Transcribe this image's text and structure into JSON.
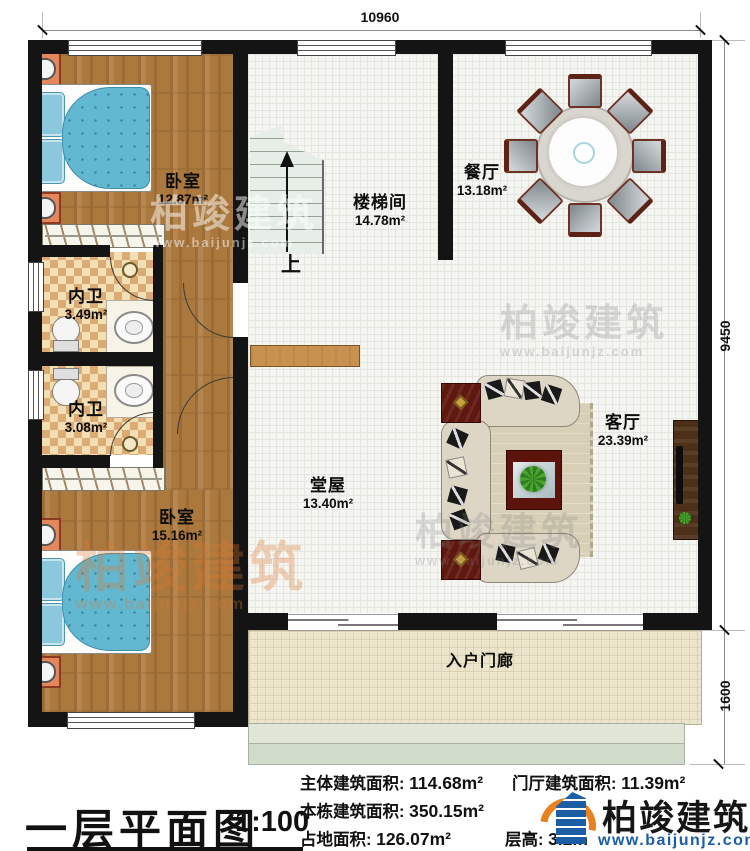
{
  "plan": {
    "dim_top": "10960",
    "dim_right_main": "9450",
    "dim_right_porch": "1600",
    "rooms": [
      {
        "name": "卧室",
        "area": "12.87m²"
      },
      {
        "name": "楼梯间",
        "area": "14.78m²"
      },
      {
        "name": "餐厅",
        "area": "13.18m²"
      },
      {
        "name": "内卫",
        "area": "3.49m²"
      },
      {
        "name": "内卫",
        "area": "3.08m²"
      },
      {
        "name": "卧室",
        "area": "15.16m²"
      },
      {
        "name": "堂屋",
        "area": "13.40m²"
      },
      {
        "name": "客厅",
        "area": "23.39m²"
      },
      {
        "name": "入户门廊",
        "area": ""
      }
    ],
    "stairs_up": "上"
  },
  "footer": {
    "title": "一层平面图",
    "scale": "1:100",
    "stats": [
      {
        "label": "主体建筑面积:",
        "value": "114.68m²"
      },
      {
        "label": "本栋建筑面积:",
        "value": "350.15m²"
      },
      {
        "label": "占地面积:",
        "value": "126.07m²"
      },
      {
        "label": "门厅建筑面积:",
        "value": "11.39m²"
      },
      {
        "label": "层高:",
        "value": "3.2m"
      }
    ],
    "logo": {
      "name": "柏竣建筑",
      "url": "www.baijunjz.com"
    }
  },
  "watermark": {
    "brand": "柏竣建筑",
    "url": "www.baijunjz.com"
  }
}
